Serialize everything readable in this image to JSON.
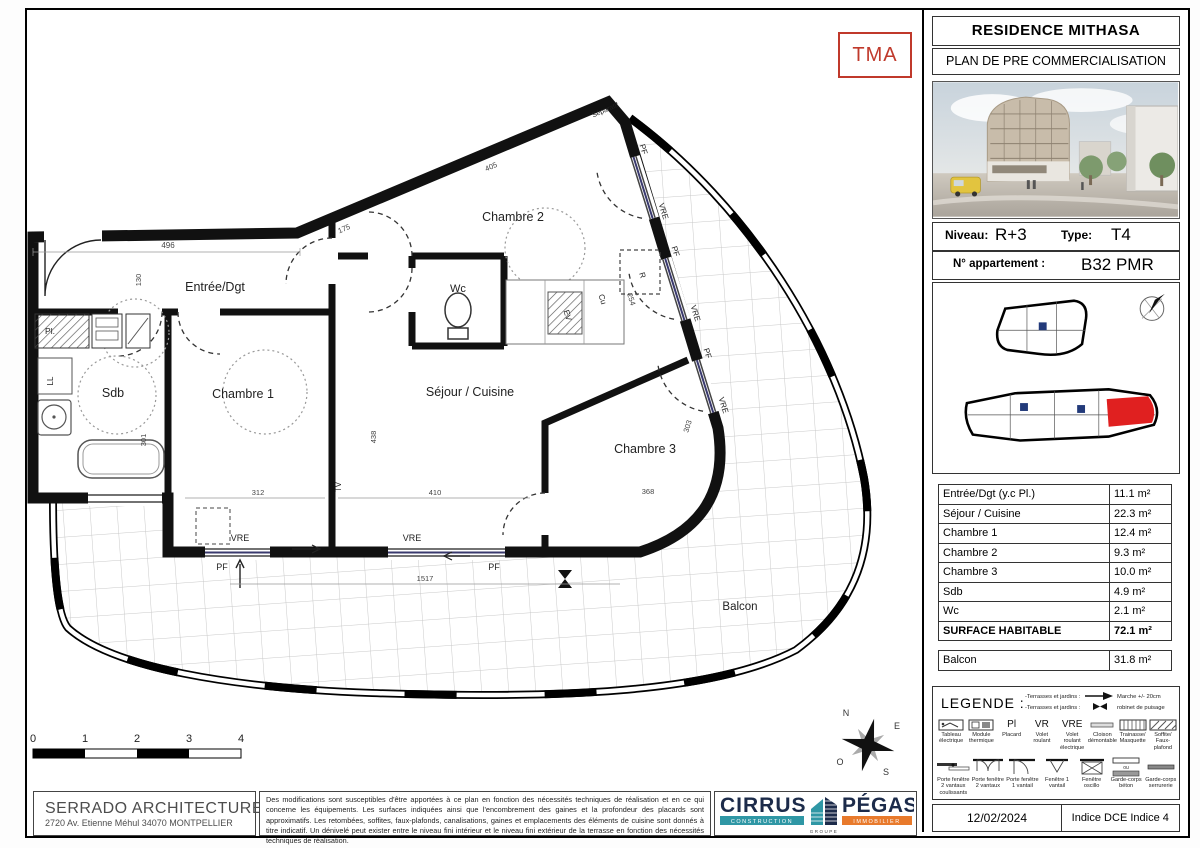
{
  "stamp": "TMA",
  "title_block": {
    "project": "RESIDENCE MITHASA",
    "subtitle": "PLAN DE PRE COMMERCIALISATION",
    "niveau_label": "Niveau:",
    "niveau": "R+3",
    "type_label": "Type:",
    "type": "T4",
    "apartment_label": "N° appartement :",
    "apartment": "B32 PMR",
    "date": "12/02/2024",
    "indice": "Indice DCE Indice 4"
  },
  "plan": {
    "rooms": [
      "Entrée/Dgt",
      "Chambre 2",
      "Wc",
      "Sdb",
      "Chambre 1",
      "Séjour / Cuisine",
      "Chambre 3",
      "Balcon"
    ],
    "labels": {
      "pl": "Pl.",
      "ll": "LL",
      "tv": "TV",
      "r": "R",
      "cu": "Cu",
      "ev": "EV",
      "vre": "VRE",
      "pf": "PF",
      "separatif": "Séparatif"
    },
    "dimensions": [
      "496",
      "130",
      "175",
      "405",
      "301",
      "312",
      "438",
      "410",
      "368",
      "303",
      "1517",
      "254"
    ],
    "scale": [
      "0",
      "1",
      "2",
      "3",
      "4"
    ],
    "compass": {
      "n": "N",
      "e": "E",
      "s": "S",
      "o": "O"
    }
  },
  "surface_table": {
    "rows": [
      {
        "label": "Entrée/Dgt  (y.c Pl.)",
        "area": "11.1 m²"
      },
      {
        "label": "Séjour / Cuisine",
        "area": "22.3 m²"
      },
      {
        "label": "Chambre 1",
        "area": "12.4 m²"
      },
      {
        "label": "Chambre 2",
        "area": "9.3 m²"
      },
      {
        "label": "Chambre 3",
        "area": "10.0 m²"
      },
      {
        "label": "Sdb",
        "area": "4.9 m²"
      },
      {
        "label": "Wc",
        "area": "2.1 m²"
      }
    ],
    "total": {
      "label": "SURFACE HABITABLE",
      "area": "72.1 m²"
    },
    "balcony": {
      "label": "Balcon",
      "area": "31.8 m²"
    }
  },
  "legend": {
    "title": "LEGENDE :",
    "top_items": [
      {
        "prefix": "-Terrasses et jardins :",
        "label": "Marche +/- 20cm"
      },
      {
        "prefix": "-Terrasses et jardins :",
        "label": "robinet de puisage"
      }
    ],
    "row1": [
      {
        "sym": "",
        "label": "Tableau électrique"
      },
      {
        "sym": "",
        "label": "Module thermique"
      },
      {
        "sym": "Pl",
        "label": "Placard"
      },
      {
        "sym": "VR",
        "label": "Volet roulant"
      },
      {
        "sym": "VRE",
        "label": "Volet roulant électrique"
      },
      {
        "sym": "",
        "label": "Cloison démontable"
      },
      {
        "sym": "",
        "label": "Trainasse/ Masquette"
      },
      {
        "sym": "",
        "label": "Soffite/ Faux-plafond"
      }
    ],
    "row2": [
      {
        "label": "Porte fenêtre 2 vantaux coulissants"
      },
      {
        "label": "Porte fenêtre 2 vantaux"
      },
      {
        "label": "Porte fenêtre 1 vantail"
      },
      {
        "label": "Fenêtre 1 vantail"
      },
      {
        "label": "Fenêtre oscillo"
      },
      {
        "label": "Garde-corps béton",
        "mid": "ou"
      },
      {
        "label": "Garde-corps serrurerie"
      }
    ]
  },
  "footer": {
    "architect": {
      "name": "SERRADO ARCHITECTURE",
      "address": "2720 Av. Etienne Méhul 34070 MONTPELLIER"
    },
    "disclaimer": "Des modifications sont susceptibles d'être apportées à ce plan en fonction des nécessités techniques de réalisation et en ce qui concerne les équipements. Les surfaces indiquées ainsi que l'encombrement des gaines et la profondeur des placards sont approximatifs. Les retombées, soffites, faux-plafonds, canalisations, gaines et emplacements des éléments de cuisine sont donnés à titre indicatif. Un dénivelé peut exister entre le niveau fini intérieur et le niveau fini extérieur de la terrasse en fonction des nécessités techniques de réalisation.",
    "logos": {
      "cirrus": "CIRRUS",
      "cirrus_sub": "CONSTRUCTION",
      "groupe": "GROUPE",
      "pegase": "PÉGASE",
      "pegase_sub": "IMMOBILIER"
    }
  },
  "colors": {
    "stamp_red": "#c0392b",
    "highlight_red": "#e02020",
    "cirrus_teal": "#2f97a5",
    "navy": "#1c2b4a",
    "pegase_orange": "#e87a2c"
  }
}
